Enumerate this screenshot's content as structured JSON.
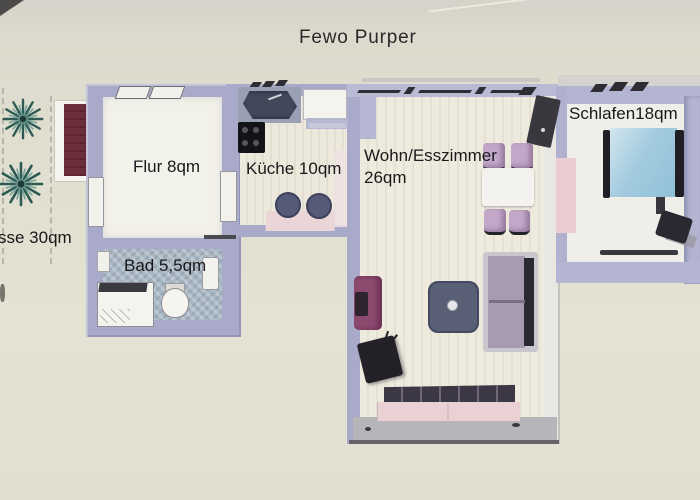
{
  "title": "Fewo Purper",
  "rooms": {
    "flur": {
      "label": "Flur 8qm",
      "area_qm": 8
    },
    "kueche": {
      "label": "Küche 10qm",
      "area_qm": 10
    },
    "wohn_esszimmer": {
      "label_line1": "Wohn/Esszimmer",
      "label_line2": "26qm",
      "area_qm": 26
    },
    "schlafzimmer": {
      "label": "Schlafen18qm",
      "area_qm": 18
    },
    "bad": {
      "label": "Bad 5,5qm",
      "area_qm": 5.5
    },
    "terrasse": {
      "label_visible": "sse 30qm",
      "area_qm": 30
    }
  },
  "furniture_icons": {
    "terrasse": [
      "plant-icon",
      "plant-icon",
      "sun-lounger-icon"
    ],
    "kueche": [
      "sink-counter-icon",
      "fridge-icon",
      "stove-icon",
      "cabinet-icon",
      "table-icon",
      "stool-icon",
      "stool-icon"
    ],
    "bad": [
      "radiator-icon",
      "shower-icon",
      "toilet-icon",
      "washbasin-icon"
    ],
    "wohn_esszimmer": [
      "tv-cabinet-icon",
      "dining-chair-icon",
      "dining-chair-icon",
      "dining-chair-icon",
      "dining-chair-icon",
      "dining-table-icon",
      "armchair-icon",
      "tv-icon",
      "coffee-table-icon",
      "sofa-icon",
      "sideboard-bench-icon"
    ],
    "schlafzimmer": [
      "wardrobe-icon",
      "double-bed-icon",
      "chair-icon"
    ]
  },
  "palette": {
    "paper": "#e0decf",
    "wall": "#a9aac9",
    "flur_floor": "#f3f2ea",
    "kitchen_floor": "#ece9dc",
    "bath_floor": "#a9b7c3",
    "bedroom_floor": "#efeee8",
    "bed_blue": "#a3cbdf",
    "sofa_mauve": "#a79bb2",
    "armchair_plum": "#8c4a6f",
    "chair_pink": "#c3a7c8",
    "bench_pink": "#ead1d4",
    "cushion_dark": "#3c3744",
    "coffee_table": "#596075",
    "lounger_maroon": "#6c2e39",
    "plant_teal": "#2d5a53",
    "balcony_gray": "#b6b5b9",
    "text": "#19191b"
  }
}
